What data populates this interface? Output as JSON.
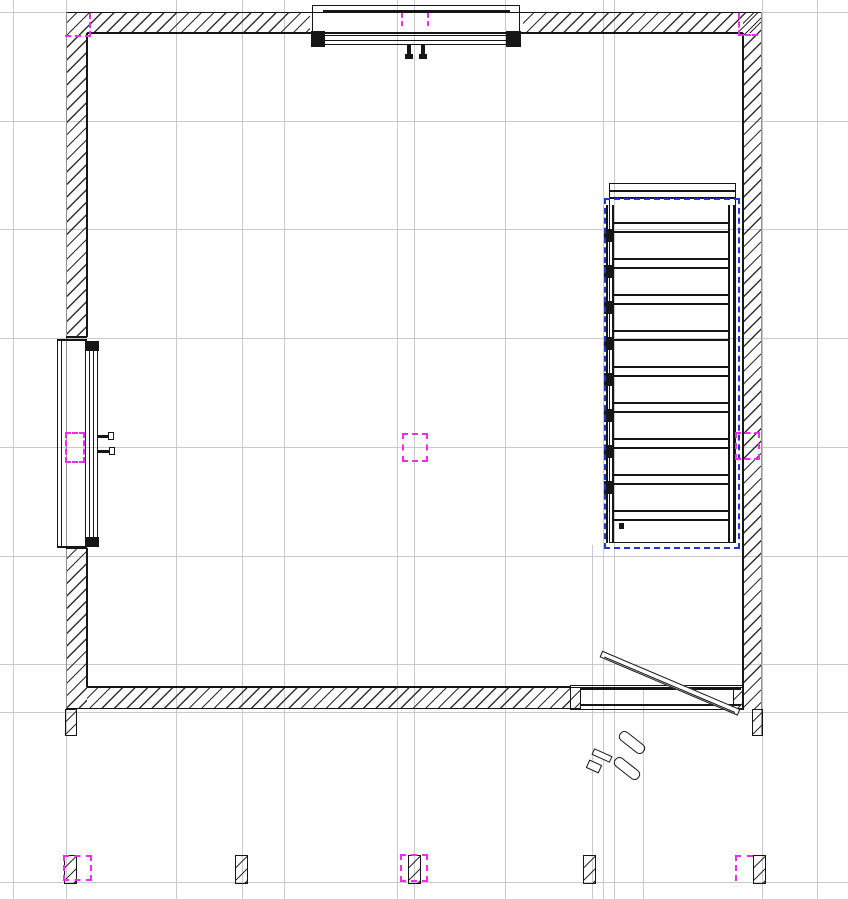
{
  "app": {
    "view_type": "floor-plan-drawing",
    "visible_text": "none"
  },
  "colors": {
    "background": "#ffffff",
    "grid_line": "#c9c9c9",
    "drawing_ink": "#161616",
    "outer_edge": "#909090",
    "hatch_line": "#2f2f2f",
    "selection_hotspot": "#ee2bee",
    "zone_boundary": "#2233d9"
  },
  "scene": {
    "grid": {
      "vertical_x": [
        13,
        66,
        176,
        242,
        284,
        397,
        414,
        505,
        603,
        614,
        762,
        817
      ],
      "vertical_partial": [
        {
          "x": 592,
          "y1": 545,
          "y2": 899
        },
        {
          "x": 643,
          "y1": 688,
          "y2": 899
        }
      ],
      "horizontal_y": [
        12,
        121,
        229,
        338,
        447,
        556,
        664,
        712,
        882
      ]
    },
    "stairs": {
      "outer": {
        "x": 609,
        "y": 183,
        "w": 127,
        "h": 360
      },
      "landing_lines_y": [
        190,
        197
      ],
      "stringers_x": [
        606,
        612,
        728,
        733
      ],
      "stringer_y1": 205,
      "stringer_y2": 543,
      "tread_x1": 614,
      "tread_x2": 728,
      "tread_y0": 222,
      "tread_step": 36,
      "tread_count": 9,
      "tread_pair_gap": 9,
      "baluster": {
        "x": 604,
        "y0": 229,
        "step": 36,
        "count": 8,
        "w": 8,
        "h": 13
      },
      "dot": {
        "x": 619,
        "y": 523,
        "w": 5,
        "h": 6
      }
    },
    "zone": {
      "x": 604,
      "y": 198,
      "w": 136,
      "h": 351
    },
    "columns": {
      "xs": [
        65,
        236,
        409,
        584,
        754
      ],
      "y": 856,
      "w": 11,
      "h": 27
    },
    "wall_stubs": [
      {
        "x": 66,
        "y": 710,
        "w": 10,
        "h": 25
      },
      {
        "x": 753,
        "y": 710,
        "w": 9,
        "h": 25
      }
    ],
    "hotspots": [
      {
        "kind": "corner-rb",
        "x": 65,
        "y": 13,
        "w": 26,
        "h": 24
      },
      {
        "kind": "corner-lb",
        "x": 738,
        "y": 13,
        "w": 20,
        "h": 23
      },
      {
        "kind": "vline",
        "x": 401,
        "y": 13,
        "w": 0,
        "h": 13
      },
      {
        "kind": "vline",
        "x": 427,
        "y": 13,
        "w": 0,
        "h": 13
      },
      {
        "kind": "rect",
        "x": 402,
        "y": 433,
        "w": 26,
        "h": 29
      },
      {
        "kind": "rect",
        "x": 65,
        "y": 432,
        "w": 20,
        "h": 31
      },
      {
        "kind": "rect",
        "x": 735,
        "y": 432,
        "w": 25,
        "h": 28
      },
      {
        "kind": "rect",
        "x": 63,
        "y": 855,
        "w": 29,
        "h": 26
      },
      {
        "kind": "rect",
        "x": 400,
        "y": 854,
        "w": 28,
        "h": 28
      },
      {
        "kind": "corner-lt",
        "x": 735,
        "y": 855,
        "w": 18,
        "h": 26
      }
    ]
  }
}
